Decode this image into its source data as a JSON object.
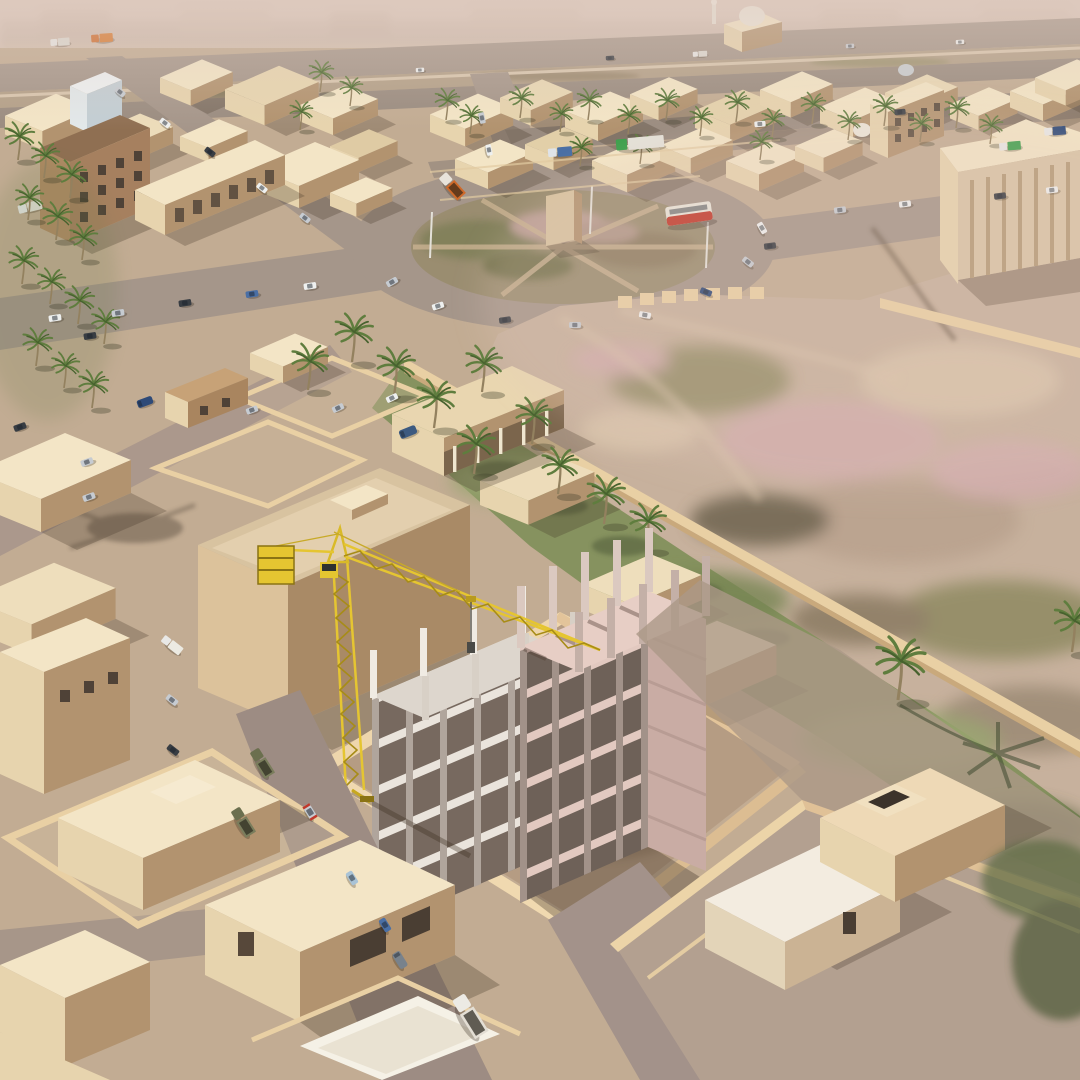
{
  "scene": {
    "title": "Desert city aerial 3D render",
    "description": "High-angle aerial 3D rendering of a hazy Middle-Eastern desert town: a yellow tower crane rises over a concrete-frame building under construction inside a walled site, surrounded by sand-colored flat-roofed houses, a large scrub-covered traffic roundabout, date palms, a green irrigated strip along long perimeter walls, an open mottled desert lot, and streets with cars, trucks and a red-and-white bus.",
    "lighting": "hazy daylight, sun from the upper left, shadows falling to the lower right",
    "view": "elevated oblique aerial view"
  },
  "regions": {
    "background": {
      "label": "Hazy pink horizon with blurred distant blocks and an elevated highway with light traffic"
    },
    "upper_city": {
      "label": "Dense low-rise district of sand-colored flat-roofed buildings lined with street palms",
      "landmarks": [
        "mosque with white dome and minaret",
        "small gray dome",
        "brown four-storey apartment block",
        "white commercial building",
        "arcaded shop row",
        "large colonnaded warehouse",
        "windowed apartment house"
      ]
    },
    "roundabout": {
      "label": "Large elliptical roundabout with scrub island, dirt pie-slice paths, central monument slab and light poles",
      "vehicles_on_ring": 8
    },
    "desert_field": {
      "label": "Open scrub desert lot mottled pink and olive, with tire tracks, a dark gully and low beige walls"
    },
    "green_strip": {
      "label": "Green lawn strip with palm shadows running beside a long sand-colored wall"
    },
    "construction_site": {
      "label": "Walled construction site",
      "building": {
        "material": "reinforced concrete frame",
        "left_wing_storeys": 5,
        "right_wing_storeys": 6,
        "state": "columns and slabs only, columns protruding above top slab"
      },
      "crane": {
        "type": "yellow tower crane",
        "parts": [
          "lattice tower",
          "jib",
          "counter-jib",
          "counterweight",
          "operator cab",
          "trolley",
          "hoist cable",
          "hook"
        ]
      }
    },
    "mid_city": {
      "label": "Walled villa yards, veranda house and a large tan flat-roofed building west of the site"
    },
    "bottom_left_houses": {
      "label": "Bright cream courtyard houses with thick walls and dark garage openings"
    },
    "bottom_right_compound": {
      "label": "Walled compound with two simple box houses, one with a rooftop stair box"
    }
  },
  "vehicles": {
    "cars": {
      "colors": [
        "white",
        "silver",
        "dark gray",
        "blue",
        "light blue",
        "navy"
      ]
    },
    "trucks": [
      "orange dump truck",
      "olive dump trucks",
      "green-cab semi trailer",
      "green box truck",
      "white flatbed truck",
      "gray van",
      "navy van"
    ],
    "bus": "red and white city bus"
  },
  "vegetation": {
    "palm_trees": "about 45 date palms",
    "grass": "patchy irrigated lawn strip"
  },
  "colors": {
    "sky1": "#dcc9bf",
    "sky2": "#cdb7a7",
    "hazeTop": "#ddc9bd",
    "sandBase": "#c2ac93",
    "sandLight": "#cdb89f",
    "sandBright": "#d7c3a9",
    "roadGray": "#a5968a",
    "roadGray2": "#9a8c80",
    "roadMauve": "#9d8c83",
    "roadMauve2": "#a3928a",
    "dirtMedian": "#b3a088",
    "islandBase": "#9a8d70",
    "scrubGreen": "#7f7f58",
    "scrubPink": "#c2a39c",
    "scrubBrown": "#8c7c60",
    "desertBase": "#c7b19d",
    "desertPink": "#d0abab",
    "desertOlive": "#8f8a62",
    "desertDark": "#6e644f",
    "desertCream": "#d9c5ab",
    "grass": "#86925f",
    "grassLight": "#9aa671",
    "grassDark": "#55613c",
    "wallBeige": "#e9d0a4",
    "wallLit": "#f2ddb4",
    "wallShade": "#c9a97c",
    "roofCream": "#f3e5c6",
    "roofTan": "#d8c3a0",
    "faceLit": "#e7d4ae",
    "faceShade": "#b2936f",
    "faceDark": "#a0805f",
    "windowDark": "#4f4237",
    "buildingBrown": "#a6805f",
    "concreteLight": "#eae4dc",
    "concreteMid": "#b0a59c",
    "concreteDark": "#77695f",
    "slabPink": "#e2c9c0",
    "slabPinkTop": "#e7cec5",
    "slabPinkSide": "#c9aca4",
    "craneYellow": "#e5c531",
    "craneDark": "#a78c17",
    "shadow": "#4a3b2e",
    "carWhite": "#eef0ef",
    "carSilver": "#c6cbd1",
    "carDark": "#383d43",
    "carBlue": "#4a6fa5",
    "carLtBlue": "#a9c3d6",
    "carNavy": "#2e4a78",
    "busRed": "#c0392b",
    "busWhite": "#e8e4da",
    "truckOrange": "#cf6a2a",
    "truckGreen": "#3da04c",
    "truckOlive": "#6b6f4e",
    "trunk": "#93815f",
    "palmGreen": "#5f7d3e",
    "palmDark": "#47622e",
    "domeWhite": "#ece6db"
  }
}
